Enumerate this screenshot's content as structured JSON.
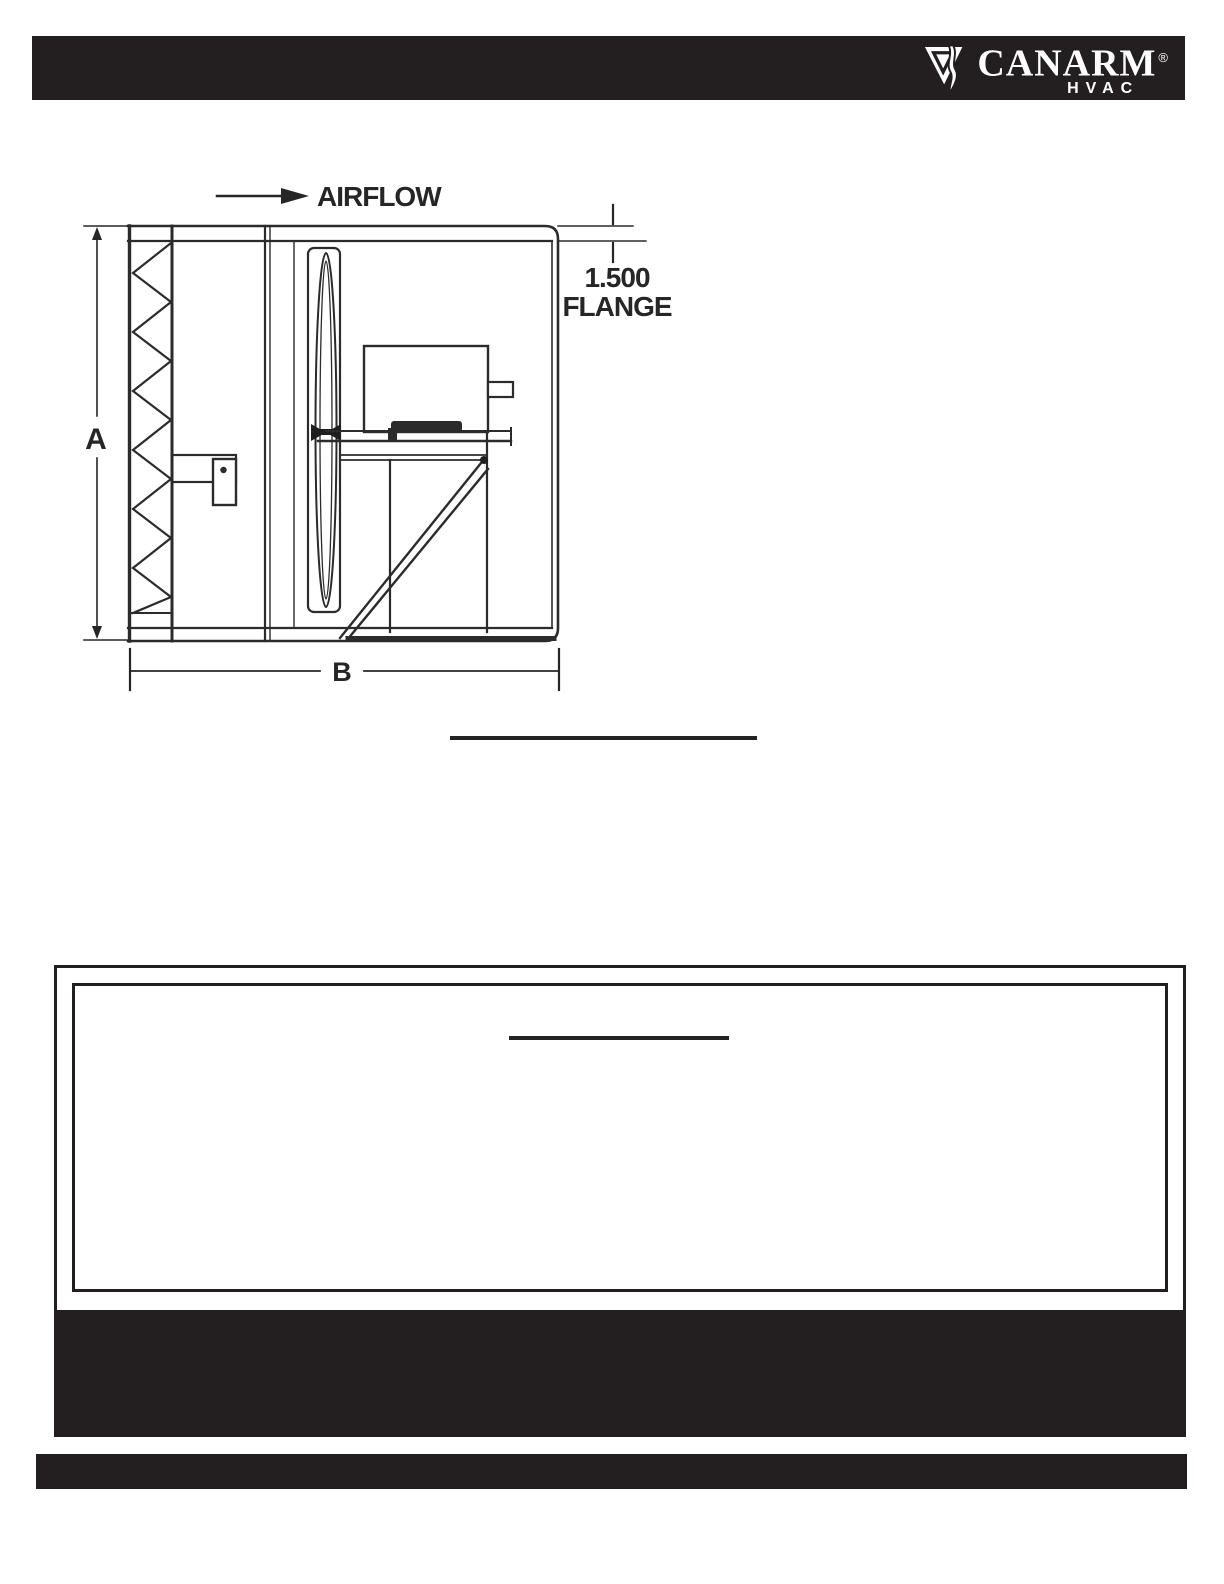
{
  "header": {
    "brand": "CANARM",
    "registered_mark": "®",
    "division": "HVAC"
  },
  "diagram": {
    "airflow_label": "AIRFLOW",
    "flange_value": "1.500",
    "flange_label": "FLANGE",
    "height_dimension_label": "A",
    "width_dimension_label": "B"
  },
  "colors": {
    "bar_black": "#231f20",
    "line_ink": "#2b2b2b",
    "background": "#ffffff"
  }
}
